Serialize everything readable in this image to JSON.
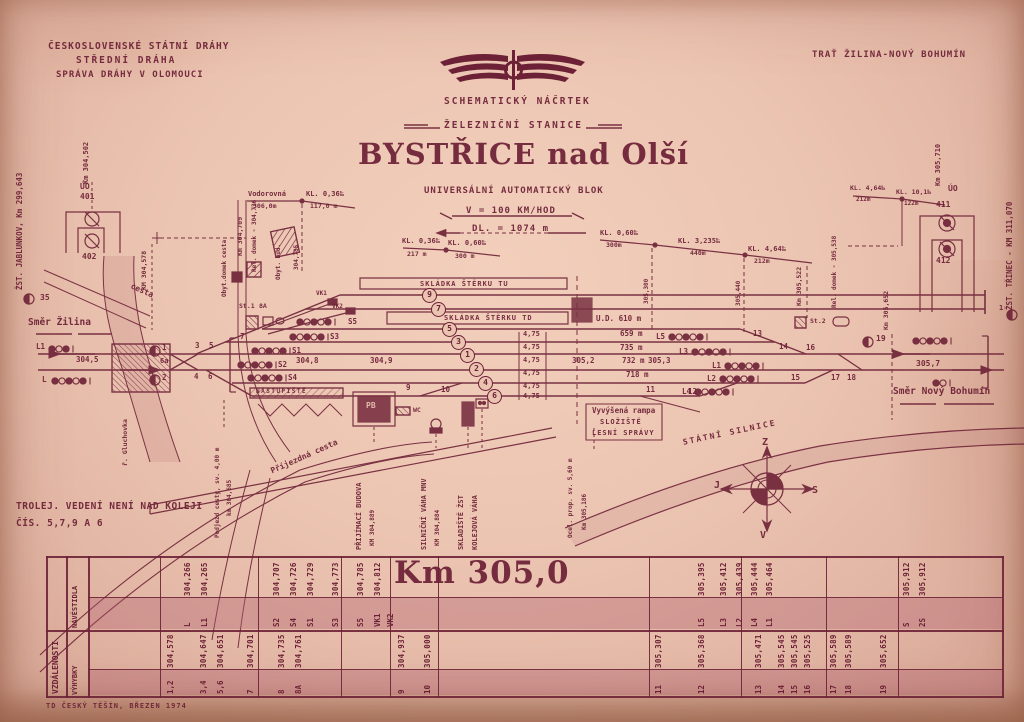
{
  "header": {
    "org1": "ČESKOSLOVENSKÉ STÁTNÍ DRÁHY",
    "org2": "STŘEDNÍ DRÁHA",
    "org3": "SPRÁVA DRÁHY V OLOMOUCI",
    "route": "TRAŤ ŽILINA-NOVÝ BOHUMÍN",
    "sketch": "SCHEMATICKÝ NÁČRTEK",
    "station_line": "ŽELEZNIČNÍ STANICE",
    "title": "BYSTŘICE nad Olší",
    "block": "UNIVERSÁLNÍ AUTOMATICKÝ BLOK",
    "speed": "V = 100 KM/HOD",
    "length": "DL. = 1074 m"
  },
  "margins": {
    "left_station": "ŽST. JABLUNKOV, Km 299,643",
    "left_km": "Km 304,502",
    "left_uo": "ÚO",
    "s401": "401",
    "s402": "402",
    "km_304_578": "KM 304,578",
    "right_station": "ŽST. TŘINEC - KM 311,070",
    "right_km": "Km 305,710",
    "right_uo": "ÚO",
    "s411": "411",
    "s412": "412"
  },
  "profile": {
    "p1g": "Vodorovná",
    "p1l": "306,0m",
    "p2g": "KL. 0,36‰",
    "p2l": "117,0 m",
    "m1": "304,785",
    "p3g": "KL. 0,36‰",
    "p3l": "217 m",
    "p4g": "KL. 0,60‰",
    "p4l": "300 m",
    "p5g": "KL. 0,60‰",
    "p5l": "300m",
    "p6g": "KL. 3,235‰",
    "p6l": "440m",
    "p7g": "KL. 4,64‰",
    "p7l": "212m",
    "m2": "305,300",
    "m3": "305,440",
    "p8g": "KL. 4,64‰",
    "p8l": "212m",
    "p9g": "KL. 10,1‰",
    "p9l": "122m"
  },
  "diagram": {
    "smer_zilina": "Směr Žilina",
    "smer_bohumin": "Směr Nový Bohumín",
    "km_304_5": "304,5",
    "km_304_8": "304,8",
    "km_304_9": "304,9",
    "km_305_2": "305,2",
    "km_305_3": "305,3",
    "km_305_7": "305,7",
    "gauge": "4,75",
    "skladka_tu": "SKLÁDKA ŠTĚRKU TU",
    "skladka_td": "SKLÁDKA ŠTĚRKU TD",
    "ud": "U.D. 610 m",
    "len_659": "659 m",
    "len_735": "735 m",
    "len_732": "732 m",
    "len_718": "718 m",
    "tracks": [
      "9",
      "7",
      "5",
      "3",
      "1",
      "2",
      "4",
      "6"
    ],
    "sig": {
      "s5": "S5",
      "s3": "S3",
      "s1": "S1",
      "s2": "S2",
      "s4": "S4",
      "l5": "L5",
      "l3": "L3",
      "l1": "L1",
      "l2": "L2",
      "l4": "L4",
      "el1": "L1",
      "el": "L"
    },
    "mk": {
      "m35": "35",
      "m19": "19",
      "m1": "1",
      "m2": "2",
      "mr": "1"
    },
    "sw": {
      "w3": "3",
      "w5": "5",
      "w4": "4",
      "w6": "6",
      "w6a": "6a",
      "w7": "7",
      "w8a": "8A",
      "w9": "9",
      "w10": "10",
      "w11": "11",
      "w12": "12",
      "w13": "13",
      "w14": "14",
      "w15": "15",
      "w16": "16",
      "w17": "17",
      "w18": "18"
    },
    "st1": "St.1",
    "st2": "St.2",
    "vk1": "VK1",
    "vk2": "VK2",
    "cesta": "cesta",
    "obyt_domek": "Obyt.domek",
    "km_304_709": "Km 304,709",
    "rel_left": "Rel. domek - 304,736",
    "obyt_bud": "Obyt. bud.",
    "km_305_522": "Km 305,522",
    "rel_right": "Rel. domek - 305,538",
    "km_305_652": "Km 305,652"
  },
  "south": {
    "nastupiste": "NÁSTUPIŠTĚ",
    "pb": "PB",
    "wc": "WC",
    "prijezdna": "Příjezdná cesta",
    "budova": "PŘIJÍMACÍ BUDOVA",
    "budova_km": "KM 304,889",
    "vaha": "SILNIČNÍ VÁHA MNV",
    "vaha_km": "KM 304,884",
    "skladiste": "SKLADIŠTĚ ŽST",
    "kol_vaha": "KOLEJOVÁ VÁHA",
    "rampa1": "Vyvýšená rampa",
    "rampa2": "SLOŽIŠTĚ",
    "rampa3": "LESNÍ SPRÁVY",
    "silnice": "STÁTNÍ SILNICE",
    "river": "ř. Gluchovka",
    "podjezd1": "Podjezd cesty, sv. 4,00 m",
    "podjezd2": "km 304,685",
    "ocel1": "Ocel. prop. sv. 5,60 m",
    "ocel2": "Km 305,186",
    "trolej1": "TROLEJ. VEDENÍ NENÍ NAD KOLEJI",
    "trolej2": "ČÍS. 5,7,9 A 6"
  },
  "compass": {
    "top": "Z",
    "left": "J",
    "right": "S",
    "bottom": "V"
  },
  "table": {
    "group": "VZDÁLENOSTI",
    "row1": "NÁVĚSTIDLA",
    "row2": "VÝHYBKY",
    "km": "Km 305,0",
    "signals": [
      {
        "label": "L",
        "value": "304,266"
      },
      {
        "label": "L1",
        "value": "304,265"
      },
      {
        "label": "S2",
        "value": "304,707"
      },
      {
        "label": "S4",
        "value": "304,726"
      },
      {
        "label": "S1",
        "value": "304,729"
      },
      {
        "label": "S3",
        "value": "304,773"
      },
      {
        "label": "S5",
        "value": "304,785"
      },
      {
        "label": "VK1",
        "value": "304,812"
      },
      {
        "label": "VK2",
        "value": ""
      },
      {
        "label": "L5",
        "value": "305,395"
      },
      {
        "label": "L3",
        "value": "305,412"
      },
      {
        "label": "L2",
        "value": "305,439"
      },
      {
        "label": "L4",
        "value": "305,444"
      },
      {
        "label": "L1",
        "value": "305,464"
      },
      {
        "label": "S",
        "value": "305,912"
      },
      {
        "label": "2S",
        "value": "305,912"
      }
    ],
    "switches": [
      {
        "label": "1,2",
        "value": "304,578"
      },
      {
        "label": "3,4",
        "value": "304,647"
      },
      {
        "label": "5,6",
        "value": "304,651"
      },
      {
        "label": "7",
        "value": "304,701"
      },
      {
        "label": "8",
        "value": "304,735"
      },
      {
        "label": "8A",
        "value": "304,761"
      },
      {
        "label": "9",
        "value": "304,937"
      },
      {
        "label": "10",
        "value": "305,000"
      },
      {
        "label": "11",
        "value": "305,307"
      },
      {
        "label": "12",
        "value": "305,368"
      },
      {
        "label": "13",
        "value": "305,471"
      },
      {
        "label": "14",
        "value": "305,545"
      },
      {
        "label": "15",
        "value": "305,545"
      },
      {
        "label": "16",
        "value": "305,525"
      },
      {
        "label": "17",
        "value": "305,589"
      },
      {
        "label": "18",
        "value": "305,589"
      },
      {
        "label": "19",
        "value": "305,652"
      }
    ]
  },
  "footer": {
    "imprint": "TD ČESKÝ TĚŠÍN, BŘEZEN 1974"
  }
}
